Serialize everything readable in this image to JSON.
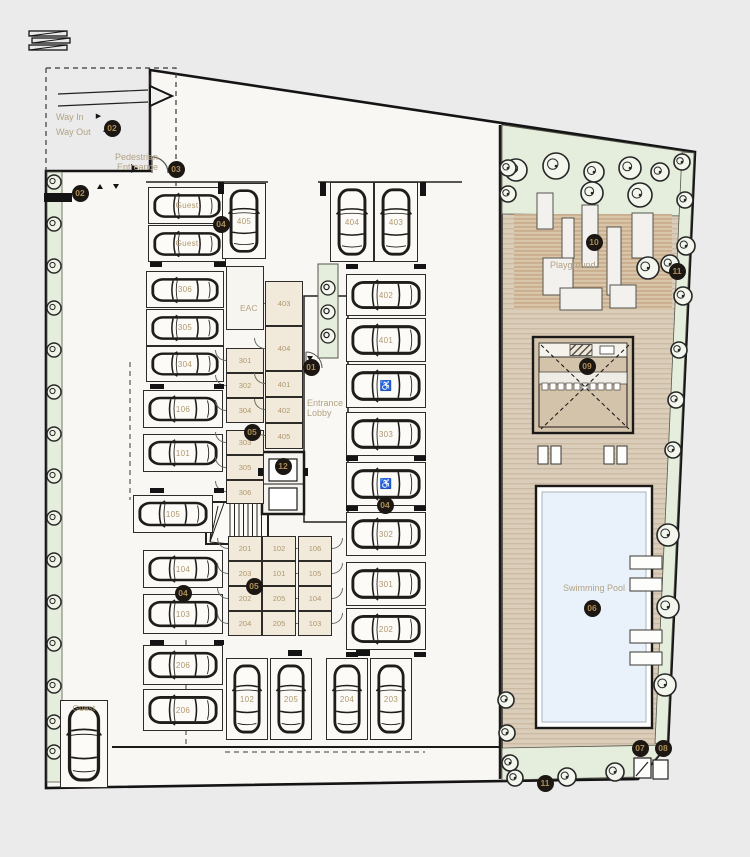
{
  "colors": {
    "page_bg": "#ebebeb",
    "site_fill": "#f8f7f4",
    "outline": "#1c1a18",
    "room_fill": "#f1eadb",
    "deck_fill": "#dacdb9",
    "deck_stripe": "#c9b69e",
    "green_fill": "#e5eedd",
    "pool_fill": "#e9f2fb",
    "marker_bg": "#1c1713",
    "marker_text": "#ad8d55",
    "label_text": "#b3a283",
    "number_text": "#b0976e"
  },
  "entry": {
    "way_in": "Way In",
    "way_out": "Way Out",
    "arrow_in": "▶",
    "arrow_out": "◀",
    "pedestrian": "Pedestrian Entreance"
  },
  "labels": {
    "eac": "EAC",
    "entrance_lobby": "Entrance Lobby",
    "playground": "Playground",
    "swimming_pool": "Swimming Pool"
  },
  "markers": [
    {
      "id": "02",
      "x": 112,
      "y": 128
    },
    {
      "id": "03",
      "x": 176,
      "y": 169
    },
    {
      "id": "02",
      "x": 80,
      "y": 193
    },
    {
      "id": "04",
      "x": 221,
      "y": 224
    },
    {
      "id": "10",
      "x": 594,
      "y": 242
    },
    {
      "id": "11",
      "x": 677,
      "y": 271
    },
    {
      "id": "09",
      "x": 587,
      "y": 366
    },
    {
      "id": "01",
      "x": 311,
      "y": 367
    },
    {
      "id": "05",
      "x": 252,
      "y": 432
    },
    {
      "id": "12",
      "x": 283,
      "y": 466
    },
    {
      "id": "04",
      "x": 385,
      "y": 505
    },
    {
      "id": "05",
      "x": 254,
      "y": 586
    },
    {
      "id": "04",
      "x": 183,
      "y": 593
    },
    {
      "id": "06",
      "x": 592,
      "y": 608
    },
    {
      "id": "07",
      "x": 640,
      "y": 748
    },
    {
      "id": "08",
      "x": 663,
      "y": 748
    },
    {
      "id": "11",
      "x": 545,
      "y": 783
    }
  ],
  "parking_stalls": [
    {
      "label": "Guest",
      "x": 148,
      "y": 187,
      "w": 78,
      "h": 37,
      "dir": "h"
    },
    {
      "label": "Guest",
      "x": 148,
      "y": 225,
      "w": 78,
      "h": 37,
      "dir": "h"
    },
    {
      "label": "405",
      "x": 222,
      "y": 183,
      "w": 44,
      "h": 76,
      "dir": "v"
    },
    {
      "label": "404",
      "x": 330,
      "y": 182,
      "w": 44,
      "h": 80,
      "dir": "v"
    },
    {
      "label": "403",
      "x": 374,
      "y": 182,
      "w": 44,
      "h": 80,
      "dir": "v"
    },
    {
      "label": "306",
      "x": 146,
      "y": 271,
      "w": 78,
      "h": 37,
      "dir": "h"
    },
    {
      "label": "305",
      "x": 146,
      "y": 309,
      "w": 78,
      "h": 37,
      "dir": "h"
    },
    {
      "label": "304",
      "x": 146,
      "y": 346,
      "w": 78,
      "h": 36,
      "dir": "h"
    },
    {
      "label": "106",
      "x": 143,
      "y": 390,
      "w": 80,
      "h": 38,
      "dir": "h"
    },
    {
      "label": "101",
      "x": 143,
      "y": 434,
      "w": 80,
      "h": 38,
      "dir": "h"
    },
    {
      "label": "105",
      "x": 133,
      "y": 495,
      "w": 80,
      "h": 38,
      "dir": "h"
    },
    {
      "label": "104",
      "x": 143,
      "y": 550,
      "w": 80,
      "h": 38,
      "dir": "h"
    },
    {
      "label": "103",
      "x": 143,
      "y": 594,
      "w": 80,
      "h": 40,
      "dir": "h"
    },
    {
      "label": "206",
      "x": 143,
      "y": 645,
      "w": 80,
      "h": 40,
      "dir": "h"
    },
    {
      "label": "206",
      "x": 143,
      "y": 689,
      "w": 80,
      "h": 42,
      "dir": "h"
    },
    {
      "label": "402",
      "x": 346,
      "y": 274,
      "w": 80,
      "h": 42,
      "dir": "h"
    },
    {
      "label": "401",
      "x": 346,
      "y": 318,
      "w": 80,
      "h": 44,
      "dir": "h"
    },
    {
      "label": "♿",
      "accessible": true,
      "x": 346,
      "y": 364,
      "w": 80,
      "h": 44,
      "dir": "h"
    },
    {
      "label": "303",
      "x": 346,
      "y": 412,
      "w": 80,
      "h": 44,
      "dir": "h"
    },
    {
      "label": "♿",
      "accessible": true,
      "x": 346,
      "y": 462,
      "w": 80,
      "h": 44,
      "dir": "h"
    },
    {
      "label": "302",
      "x": 346,
      "y": 512,
      "w": 80,
      "h": 44,
      "dir": "h"
    },
    {
      "label": "301",
      "x": 346,
      "y": 562,
      "w": 80,
      "h": 44,
      "dir": "h"
    },
    {
      "label": "202",
      "x": 346,
      "y": 608,
      "w": 80,
      "h": 42,
      "dir": "h"
    },
    {
      "label": "102",
      "x": 226,
      "y": 658,
      "w": 42,
      "h": 82,
      "dir": "v"
    },
    {
      "label": "205",
      "x": 270,
      "y": 658,
      "w": 42,
      "h": 82,
      "dir": "v"
    },
    {
      "label": "204",
      "x": 326,
      "y": 658,
      "w": 42,
      "h": 82,
      "dir": "v"
    },
    {
      "label": "203",
      "x": 370,
      "y": 658,
      "w": 42,
      "h": 82,
      "dir": "v"
    },
    {
      "label": "Guest",
      "x": 60,
      "y": 700,
      "w": 48,
      "h": 88,
      "dir": "v",
      "label_pos": "top"
    }
  ],
  "storage_rooms": [
    {
      "label": "301",
      "x": 226,
      "y": 348,
      "w": 38,
      "h": 25,
      "door": "l"
    },
    {
      "label": "302",
      "x": 226,
      "y": 373,
      "w": 38,
      "h": 25,
      "door": "l"
    },
    {
      "label": "304",
      "x": 226,
      "y": 398,
      "w": 38,
      "h": 25,
      "door": "l"
    },
    {
      "label": "303",
      "x": 226,
      "y": 430,
      "w": 38,
      "h": 25,
      "door": "l"
    },
    {
      "label": "305",
      "x": 226,
      "y": 455,
      "w": 38,
      "h": 25,
      "door": "l"
    },
    {
      "label": "306",
      "x": 226,
      "y": 480,
      "w": 38,
      "h": 24,
      "door": "l"
    },
    {
      "label": "403",
      "x": 265,
      "y": 281,
      "w": 38,
      "h": 45,
      "door": "l"
    },
    {
      "label": "404",
      "x": 265,
      "y": 326,
      "w": 38,
      "h": 45,
      "door": "l"
    },
    {
      "label": "401",
      "x": 265,
      "y": 371,
      "w": 38,
      "h": 26,
      "door": "l"
    },
    {
      "label": "402",
      "x": 265,
      "y": 397,
      "w": 38,
      "h": 26,
      "door": "l"
    },
    {
      "label": "405",
      "x": 265,
      "y": 423,
      "w": 38,
      "h": 26,
      "door": "l"
    },
    {
      "label": "201",
      "x": 228,
      "y": 536,
      "w": 34,
      "h": 25,
      "door": "l"
    },
    {
      "label": "203",
      "x": 228,
      "y": 561,
      "w": 34,
      "h": 25,
      "door": "l"
    },
    {
      "label": "202",
      "x": 228,
      "y": 586,
      "w": 34,
      "h": 25,
      "door": "l"
    },
    {
      "label": "204",
      "x": 228,
      "y": 611,
      "w": 34,
      "h": 25,
      "door": "l"
    },
    {
      "label": "102",
      "x": 262,
      "y": 536,
      "w": 34,
      "h": 25,
      "door": "r"
    },
    {
      "label": "101",
      "x": 262,
      "y": 561,
      "w": 34,
      "h": 25,
      "door": "r"
    },
    {
      "label": "205",
      "x": 262,
      "y": 586,
      "w": 34,
      "h": 25,
      "door": "r"
    },
    {
      "label": "205",
      "x": 262,
      "y": 611,
      "w": 34,
      "h": 25,
      "door": "r"
    },
    {
      "label": "106",
      "x": 298,
      "y": 536,
      "w": 34,
      "h": 25,
      "door": "r"
    },
    {
      "label": "105",
      "x": 298,
      "y": 561,
      "w": 34,
      "h": 25,
      "door": "r"
    },
    {
      "label": "104",
      "x": 298,
      "y": 586,
      "w": 34,
      "h": 25,
      "door": "r"
    },
    {
      "label": "103",
      "x": 298,
      "y": 611,
      "w": 34,
      "h": 25,
      "door": "r"
    },
    {
      "label": "EAC",
      "x": 226,
      "y": 266,
      "w": 38,
      "h": 64,
      "eac": true
    }
  ],
  "wall_stubs": [
    [
      150,
      262,
      12,
      5
    ],
    [
      214,
      262,
      12,
      5
    ],
    [
      150,
      384,
      14,
      5
    ],
    [
      214,
      384,
      10,
      5
    ],
    [
      150,
      488,
      14,
      5
    ],
    [
      214,
      488,
      10,
      5
    ],
    [
      150,
      640,
      14,
      5
    ],
    [
      214,
      640,
      10,
      5
    ],
    [
      346,
      264,
      12,
      5
    ],
    [
      414,
      264,
      12,
      5
    ],
    [
      346,
      456,
      12,
      5
    ],
    [
      414,
      456,
      12,
      5
    ],
    [
      346,
      506,
      12,
      5
    ],
    [
      414,
      506,
      12,
      5
    ],
    [
      346,
      652,
      12,
      5
    ],
    [
      414,
      652,
      12,
      5
    ],
    [
      288,
      650,
      14,
      6
    ],
    [
      356,
      650,
      14,
      6
    ],
    [
      218,
      182,
      6,
      12
    ],
    [
      320,
      182,
      6,
      14
    ],
    [
      420,
      182,
      6,
      14
    ],
    [
      44,
      193,
      28,
      9
    ],
    [
      258,
      468,
      5,
      8
    ],
    [
      303,
      468,
      5,
      8
    ]
  ],
  "trees": {
    "shrub_x": 54,
    "shrub_ys": [
      182,
      224,
      266,
      308,
      350,
      392,
      434,
      476,
      518,
      560,
      602,
      644,
      686,
      722,
      752
    ],
    "deck": [
      [
        516,
        170,
        11
      ],
      [
        556,
        166,
        13
      ],
      [
        594,
        172,
        10
      ],
      [
        630,
        168,
        11
      ],
      [
        660,
        172,
        9
      ],
      [
        682,
        162,
        8
      ],
      [
        508,
        168,
        8
      ],
      [
        508,
        194,
        8
      ],
      [
        592,
        193,
        11
      ],
      [
        640,
        195,
        12
      ],
      [
        648,
        268,
        11
      ],
      [
        670,
        264,
        9
      ],
      [
        685,
        200,
        8
      ],
      [
        686,
        246,
        9
      ],
      [
        683,
        296,
        9
      ],
      [
        679,
        350,
        8
      ],
      [
        676,
        400,
        8
      ],
      [
        673,
        450,
        8
      ],
      [
        668,
        535,
        11
      ],
      [
        668,
        607,
        11
      ],
      [
        665,
        685,
        11
      ],
      [
        506,
        700,
        8
      ],
      [
        507,
        733,
        8
      ],
      [
        510,
        763,
        8
      ],
      [
        515,
        778,
        8
      ],
      [
        567,
        777,
        9
      ],
      [
        615,
        772,
        9
      ]
    ]
  }
}
